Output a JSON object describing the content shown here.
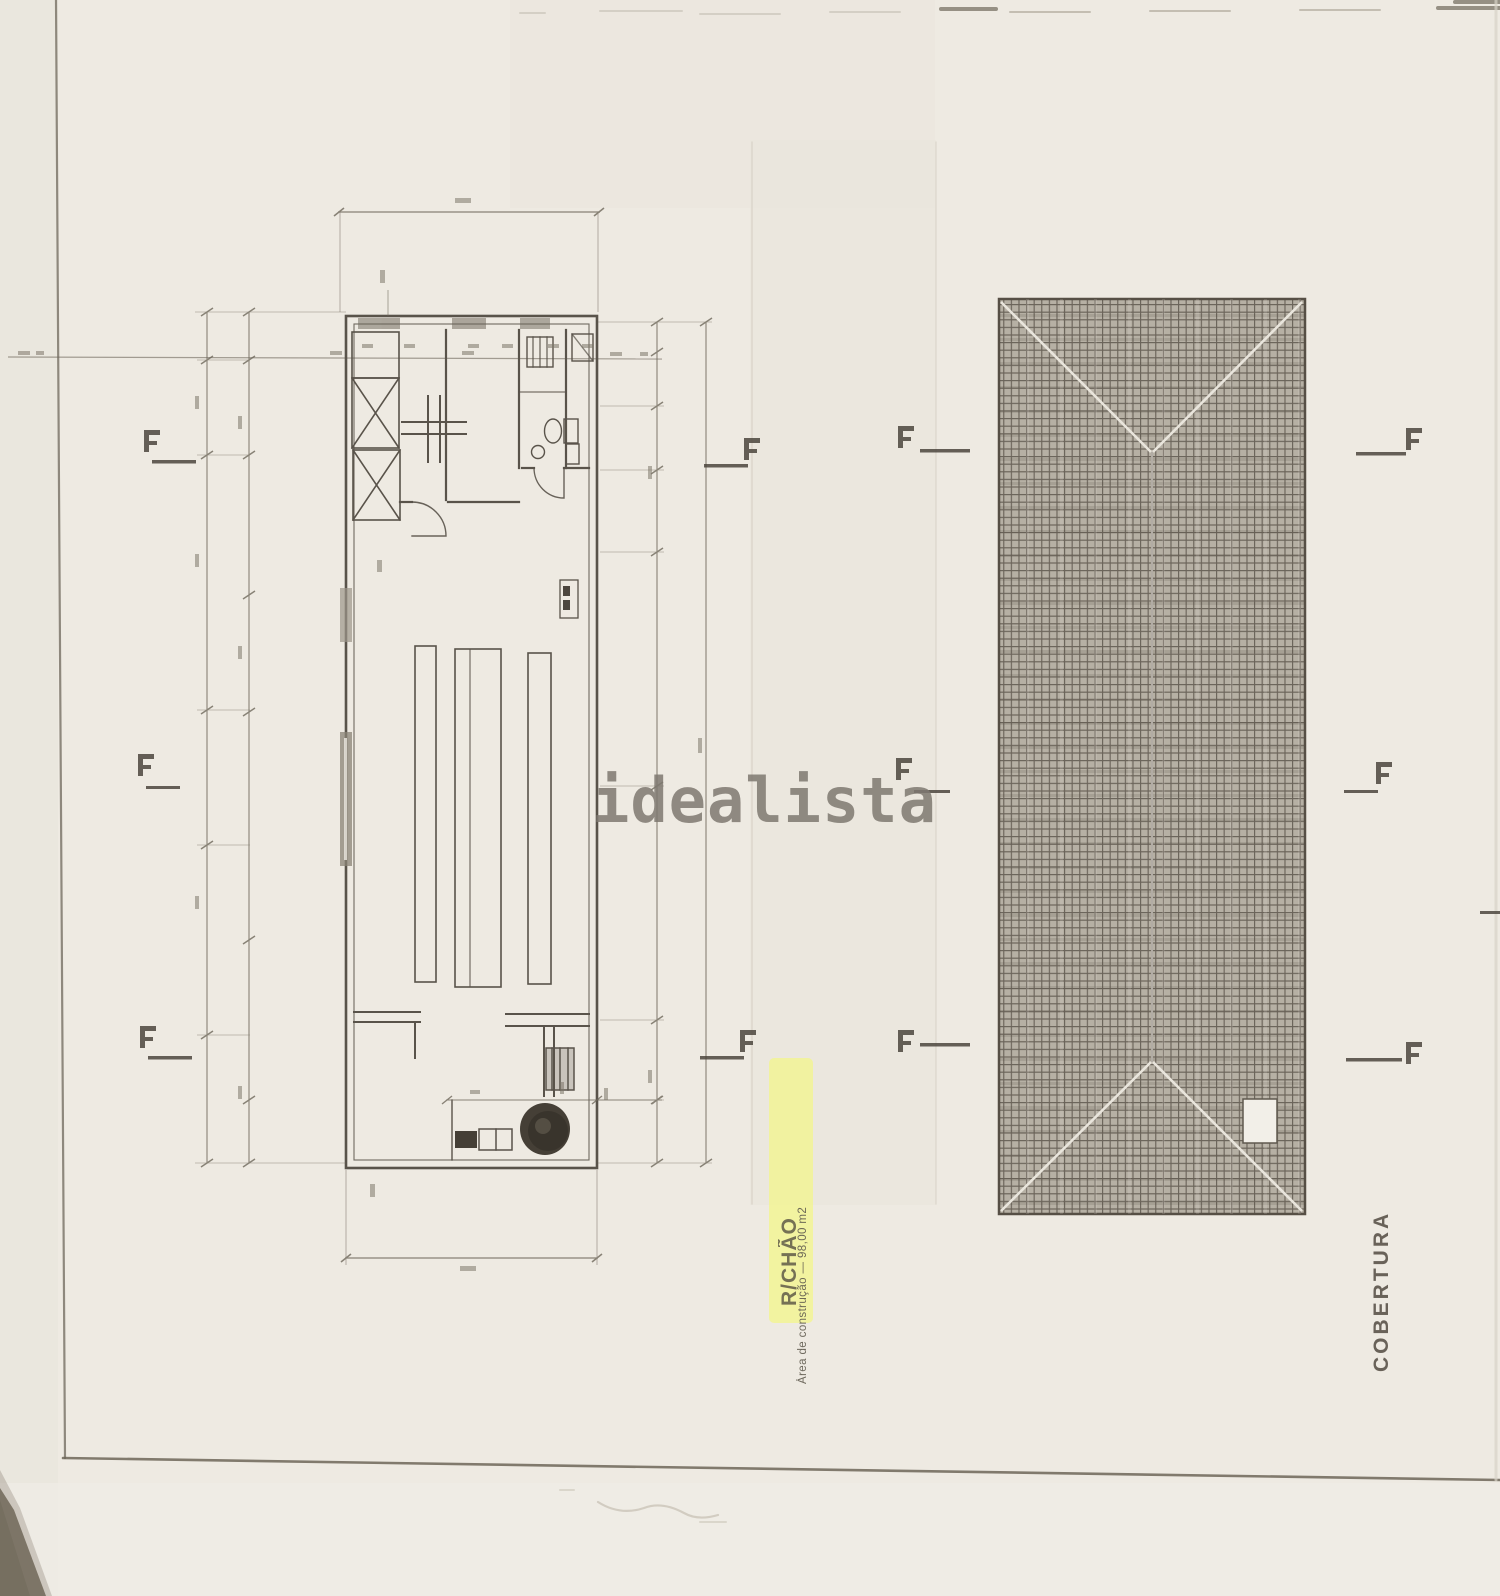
{
  "document": {
    "watermark": "idealista",
    "floor_plan": {
      "label": "R/CHÃO",
      "area_caption": "Área de construção — 98,00 m2"
    },
    "roof_plan": {
      "label": "COBERTURA"
    }
  },
  "colors": {
    "paper": "#eeeae2",
    "ink": "#59534a",
    "roof_hatch_bg": "#b6b0a4",
    "roof_hatch_line": "#6b645a",
    "highlight_yellow": "#f3f590",
    "watermark_gray": "#7e7870"
  }
}
